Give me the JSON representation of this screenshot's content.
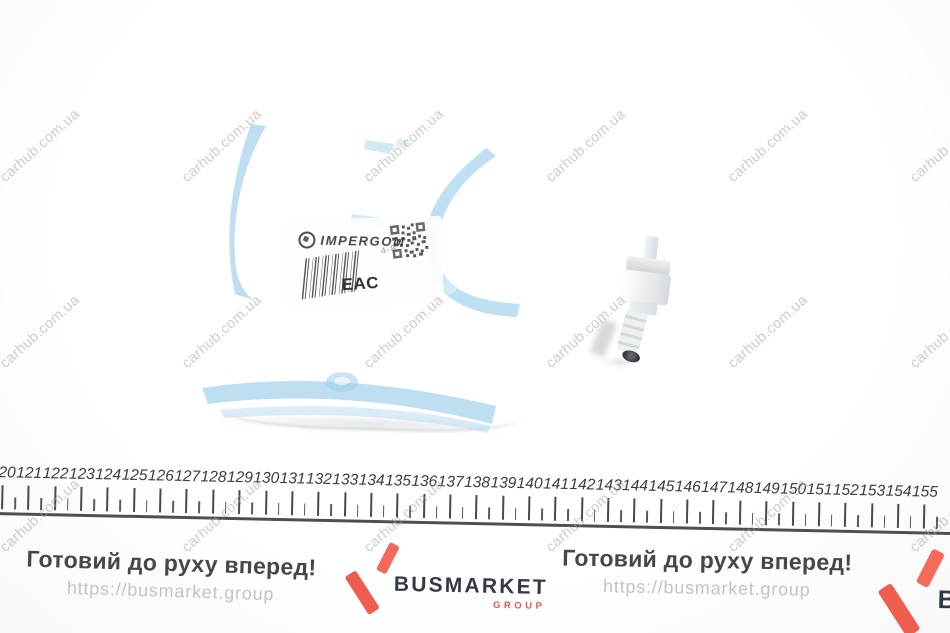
{
  "watermark": {
    "text": "carhub.com.ua",
    "color": "#a3a3a3",
    "columns_x": [
      40,
      222,
      404,
      586,
      768,
      950
    ],
    "rows_y": [
      146,
      332,
      516
    ]
  },
  "package": {
    "brand": "IMPERGOM",
    "eac_label": "EAC",
    "faint_code": "4-8"
  },
  "part": {
    "description": "white plastic check valve"
  },
  "ruler": {
    "labels": [
      120,
      121,
      122,
      123,
      124,
      125,
      126,
      127,
      128,
      129,
      130,
      131,
      132,
      133,
      134,
      135,
      136,
      137,
      138,
      139,
      140,
      141,
      142,
      143,
      144,
      145,
      146,
      147,
      148,
      149,
      150,
      151,
      152,
      153,
      154,
      155
    ]
  },
  "footer": {
    "slogan": "Готовий до руху вперед!",
    "url": "https://busmarket.group",
    "brand": "BUSMARKET",
    "brand_sub": "GROUP",
    "accent_color": "#f4695a",
    "brand_text_color": "#333a44"
  }
}
